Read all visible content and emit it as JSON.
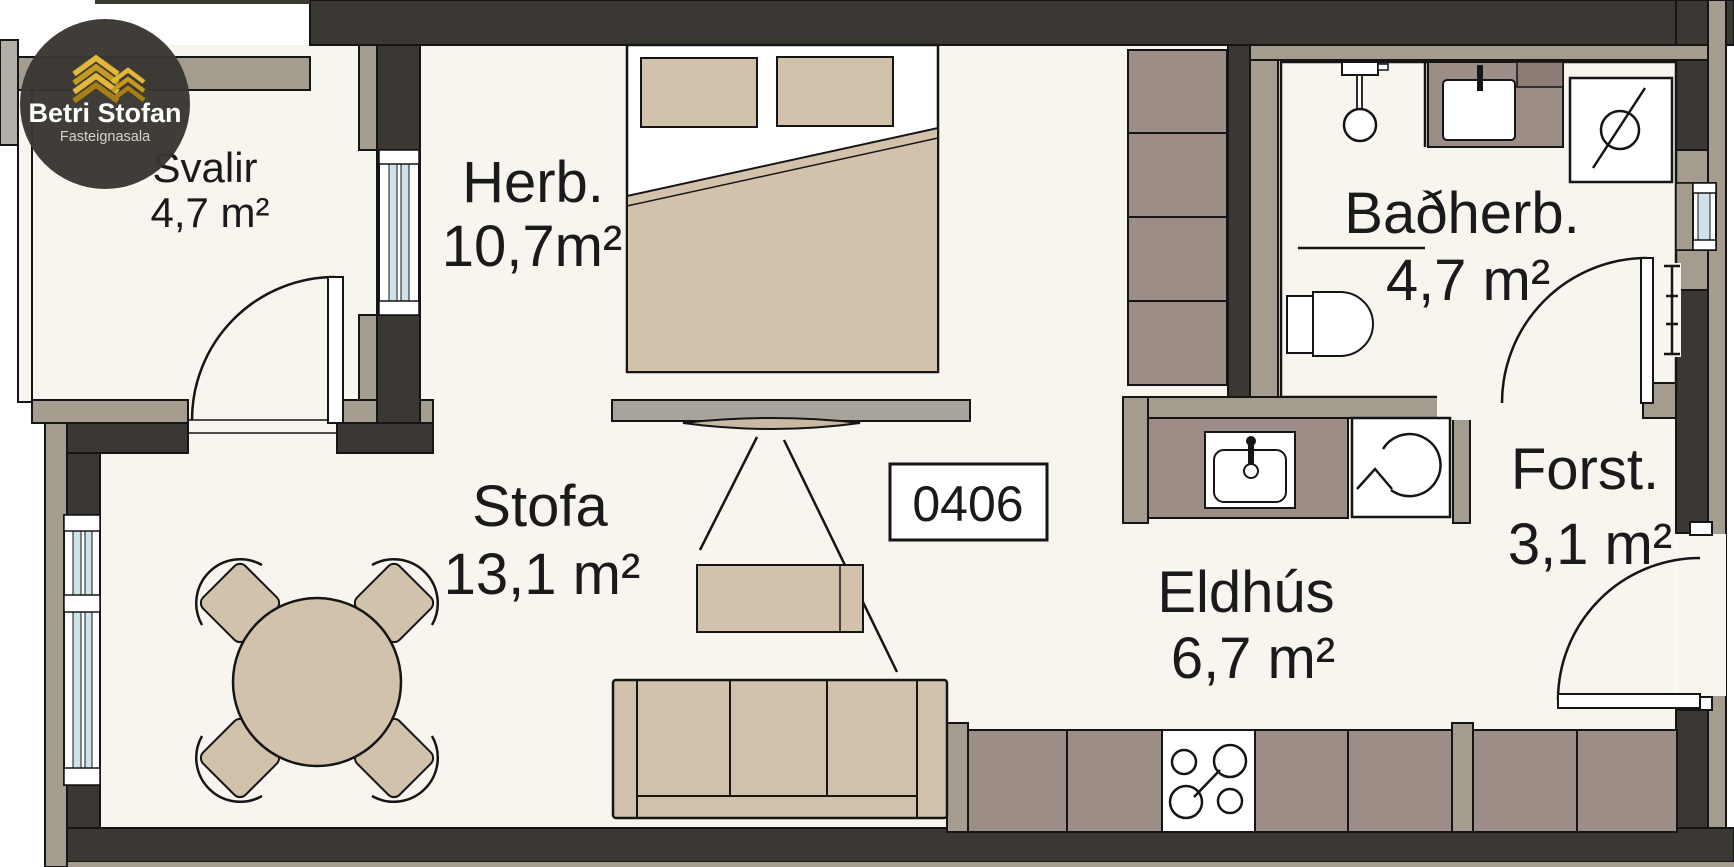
{
  "logo": {
    "name": "Betri Stofan",
    "subtitle": "Fasteignasala",
    "mark": "gold-chevron-buildings-icon"
  },
  "unit_number": "0406",
  "rooms": {
    "svalir": {
      "name": "Svalir",
      "area": "4,7 m²"
    },
    "herb": {
      "name": "Herb.",
      "area": "10,7m²"
    },
    "badherb": {
      "name": "Baðherb.",
      "area": "4,7 m²"
    },
    "stofa": {
      "name": "Stofa",
      "area": "13,1 m²"
    },
    "eldhus": {
      "name": "Eldhús",
      "area": "6,7 m²"
    },
    "forst": {
      "name": "Forst.",
      "area": "3,1 m²"
    }
  },
  "fixtures": [
    "double-bed",
    "wardrobe",
    "tv-on-bench",
    "coffee-table",
    "sofa",
    "round-dining-table-4-chairs",
    "kitchen-sink",
    "fridge",
    "stove-4-burners",
    "kitchen-counter",
    "shower-fixture",
    "vanity-basin",
    "washing-machine",
    "toilet",
    "radiator",
    "balcony-door",
    "bathroom-door",
    "entry-door"
  ],
  "colors": {
    "wall_dark": "#3b3733",
    "wall_light": "#a49d8f",
    "floor": "#f8f4ee",
    "furniture_tan": "#d2c2ac",
    "cabinet_taupe": "#9c8e87",
    "bench_gray": "#a8a49b",
    "glass_blue": "#cfe2ea",
    "logo_bg": "#3a3733",
    "logo_gold": "#d4a62c",
    "text": "#1a1a1a"
  }
}
